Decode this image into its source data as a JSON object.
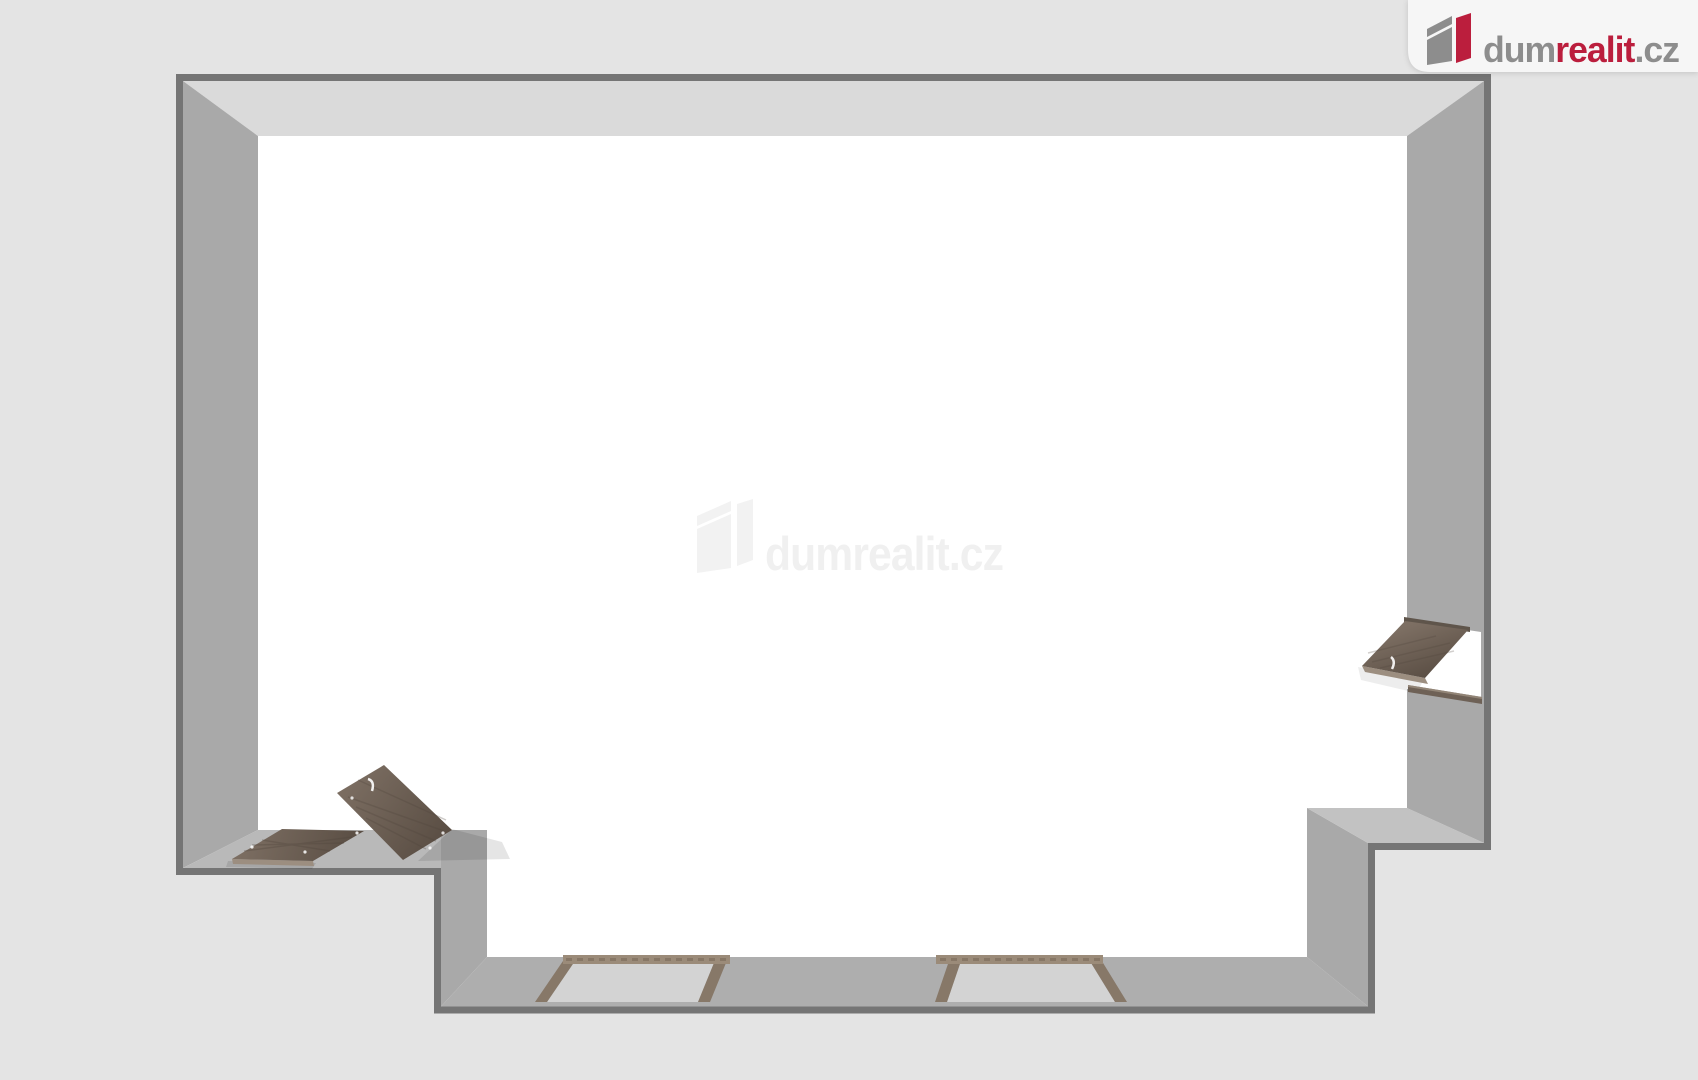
{
  "brand": {
    "prefix": "dum",
    "accent": "realit",
    "suffix": ".cz"
  },
  "watermark": {
    "text": "dumrealit.cz"
  },
  "colors": {
    "background": "#e4e4e4",
    "cardBg": "#f6f6f6",
    "brandRed": "#bb1e3d",
    "brandGray": "#8d8d8d",
    "outline": "#757575",
    "floor": "#ffffff",
    "wallTop": "#dadada",
    "wallSide": "#a9a9a9",
    "wallLedge": "#b9b9b9",
    "wallLedgeLight": "#c2c2c2",
    "wallBottom": "#aeaeae",
    "wood": "#6e6156",
    "woodDark": "#584c42",
    "woodLight": "#7d6f63",
    "woodEdge": "#9c8e80",
    "windowFrame": "#877868",
    "windowFrameTop": "#9b8b79",
    "windowGlass": "#d3d3d3",
    "watermark": "#f0f0f0",
    "watermarkIcon": "#f2f2f2"
  }
}
